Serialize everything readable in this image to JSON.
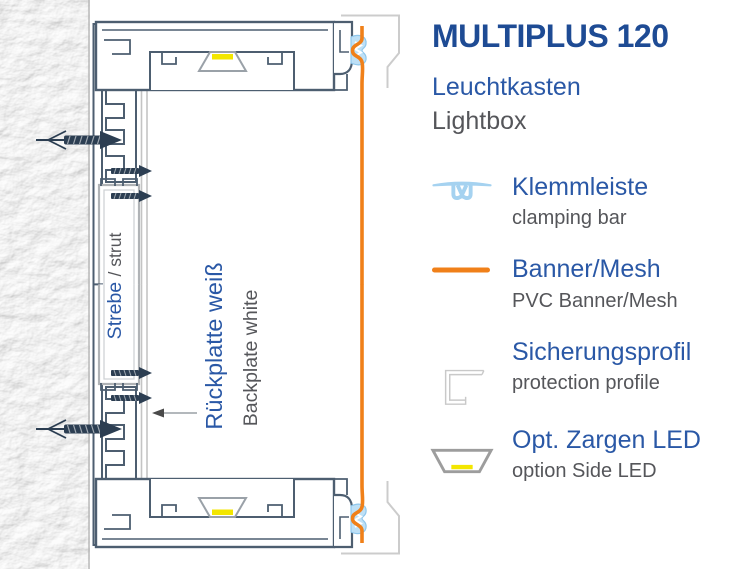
{
  "header": {
    "title": "MULTIPLUS 120",
    "subtitle_de": "Leuchtkasten",
    "subtitle_en": "Lightbox"
  },
  "legend": {
    "items": [
      {
        "icon": "clamping-bar-icon",
        "label_de": "Klemmleiste",
        "label_en": "clamping bar"
      },
      {
        "icon": "banner-line-icon",
        "label_de": "Banner/Mesh",
        "label_en": "PVC Banner/Mesh"
      },
      {
        "icon": "protection-profile-icon",
        "label_de": "Sicherungsprofil",
        "label_en": "protection profile"
      },
      {
        "icon": "side-led-icon",
        "label_de": "Opt. Zargen LED",
        "label_en": "option Side LED"
      }
    ]
  },
  "drawing": {
    "strut_label_de": "Strebe ",
    "strut_label_en": "/ strut",
    "backplate_label_de": "Rückplatte weiß",
    "backplate_label_en": "Backplate white"
  },
  "colors": {
    "title_blue": "#1e4b94",
    "label_blue": "#2a58a6",
    "text_gray": "#55565a",
    "banner_orange": "#f08019",
    "profile_slate": "#4d5e70",
    "protection_gray": "#cccccc",
    "clamp_light_blue": "#bee0f6",
    "led_yellow": "#f3e600",
    "strut_silver": "#b0b3b6",
    "screw_navy": "#2c3e52"
  }
}
